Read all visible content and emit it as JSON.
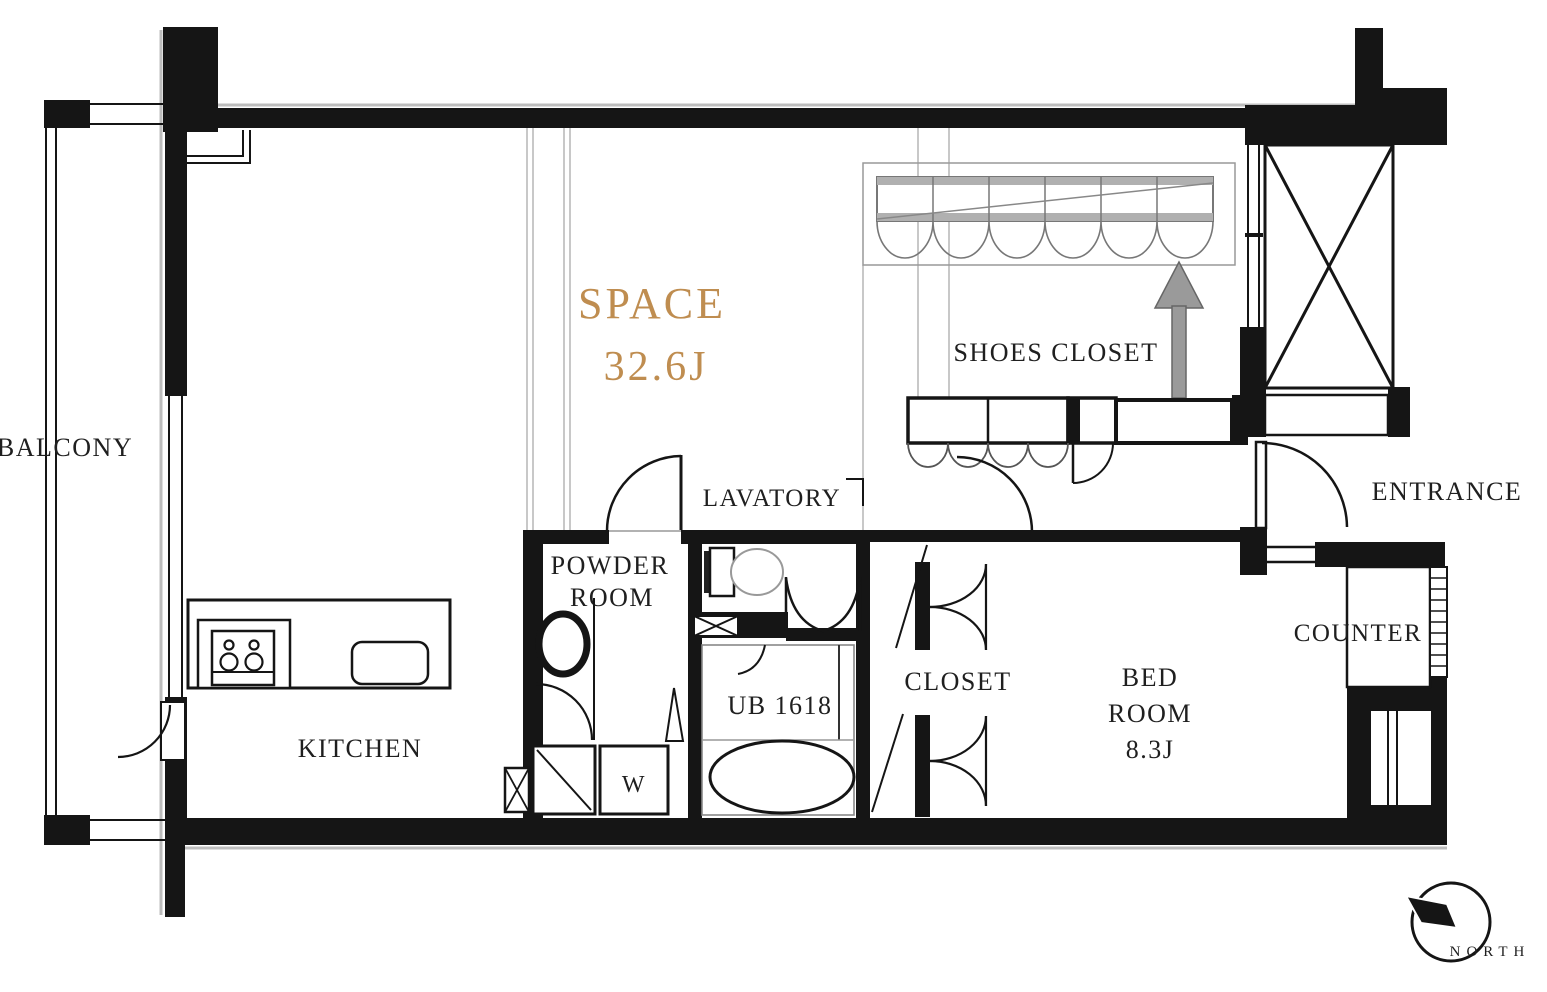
{
  "colors": {
    "wall": "#151515",
    "accent": "#bf8d50",
    "guide_gray": "#b0b0b0",
    "fixture_gray": "#9a9a9a"
  },
  "labels": {
    "balcony": "BALCONY",
    "space_name": "SPACE",
    "space_area": "32.6J",
    "shoes_closet": "SHOES CLOSET",
    "entrance": "ENTRANCE",
    "lavatory": "LAVATORY",
    "powder_room_line1": "POWDER",
    "powder_room_line2": "ROOM",
    "unit_bath": "UB 1618",
    "closet": "CLOSET",
    "bedroom_line1": "BED",
    "bedroom_line2": "ROOM",
    "bedroom_area": "8.3J",
    "counter": "COUNTER",
    "kitchen": "KITCHEN",
    "washer": "W",
    "compass": "NORTH"
  }
}
